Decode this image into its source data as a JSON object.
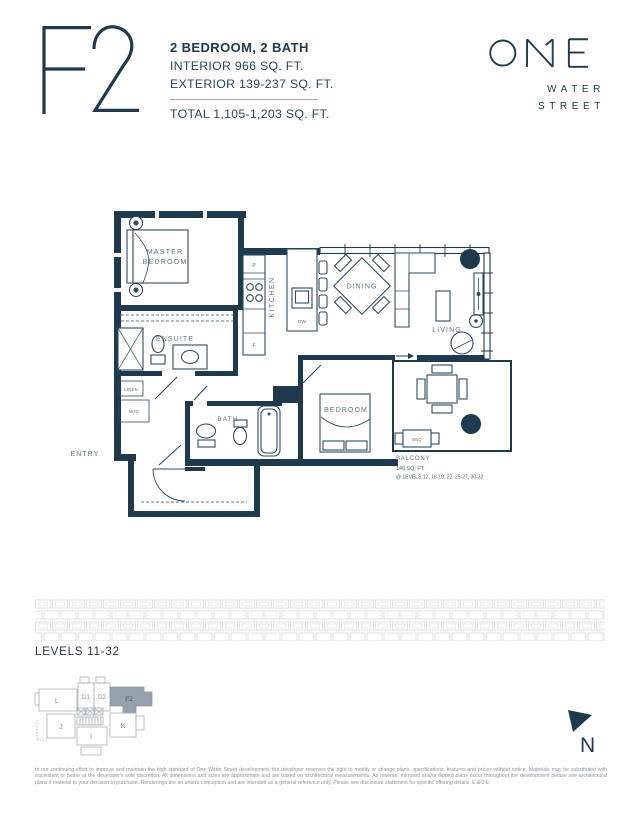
{
  "header": {
    "plan_code": "F2",
    "type": "2 BEDROOM, 2 BATH",
    "interior": "INTERIOR 966 SQ. FT.",
    "exterior": "EXTERIOR 139-237 SQ. FT.",
    "total": "TOTAL 1,105-1,203 SQ. FT."
  },
  "brand": {
    "name": "ONE",
    "line1": "WATER",
    "line2": "STREET"
  },
  "floorplan": {
    "labels": {
      "master_line1": "MASTER",
      "master_line2": "BEDROOM",
      "ensuite": "ENSUITE",
      "kitchen": "KITCHEN",
      "dining": "DINING",
      "living": "LIVING",
      "bedroom": "BEDROOM",
      "bath": "BATH",
      "entry": "ENTRY",
      "linen": "LINEN",
      "wd": "W/D",
      "p": "P",
      "f": "F",
      "dw": "DW",
      "bbq": "BBQ",
      "balcony": "BALCONY"
    },
    "balcony_area": "146 SQ. FT.",
    "balcony_levels": "@ LEVELS 12, 16-19, 22, 25-27, 30-32"
  },
  "levels_label": "LEVELS 11-32",
  "keyplan": {
    "units": {
      "l": "L",
      "d1": "D1",
      "d2": "D2",
      "f2": "F2",
      "j": "J",
      "i": "I",
      "k": "K"
    },
    "highlighted": "F2"
  },
  "compass": {
    "label": "N"
  },
  "disclaimer": "In our continuing effort to improve and maintain the high standard of One Water Street development, the developer reserves the right to modify or change plans, specifications, features and prices without notice. Materials may be substituted with equivalent or better at the developer's sole discretion. All dimensions and sizes are approximate and are based on architectural measurements. As reverse, mirrored and/or flipped plans occur throughout the development please see architectural plans if material to your decision to purchase. Renderings are an artist's conception and are intended as a general reference only. Please see disclosure statement for specific offering details. E.&O.E",
  "colors": {
    "navy": "#1f3a4d",
    "furniture_line": "#2e4c60",
    "room_label": "#5e7585",
    "note_text": "#4c6677",
    "pattern": "#dce3e7",
    "keyplan_line": "#a8b2b9",
    "keyplan_fill": "#95a1ab",
    "disclaimer": "#8795a1"
  }
}
